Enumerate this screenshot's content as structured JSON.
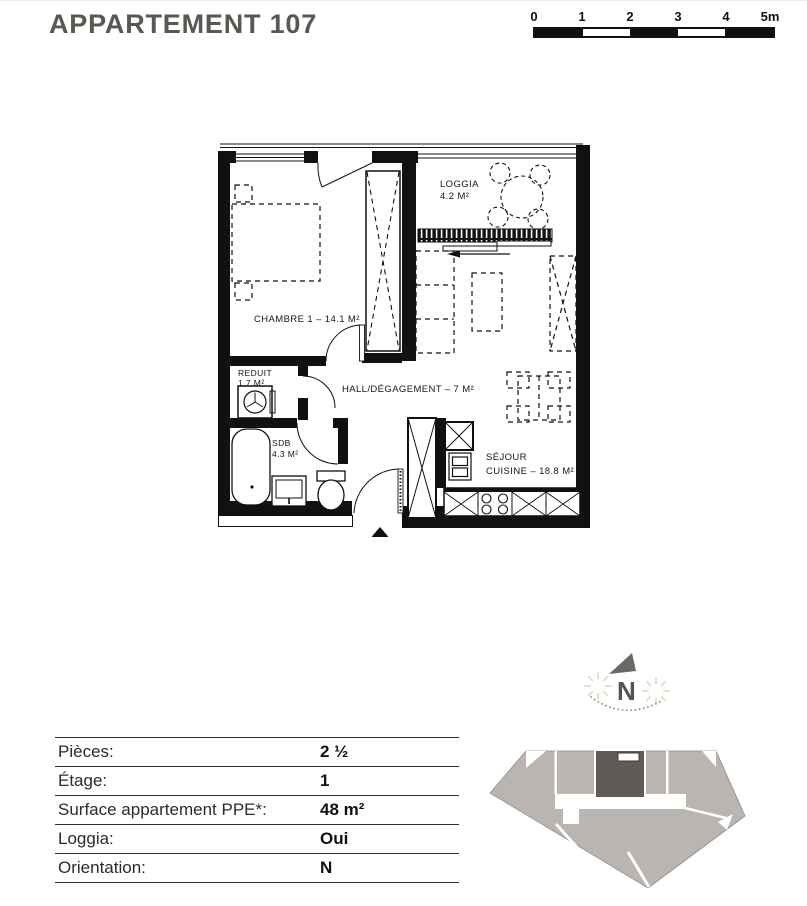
{
  "header": {
    "title": "APPARTEMENT 107"
  },
  "scale_bar": {
    "ticks": [
      "0",
      "1",
      "2",
      "3",
      "4",
      "5m"
    ]
  },
  "floor_plan": {
    "rooms": {
      "loggia": {
        "name": "LOGGIA",
        "area": "4.2 M²"
      },
      "chambre": {
        "label": "CHAMBRE 1 – 14.1 M²"
      },
      "reduit": {
        "name": "REDUIT",
        "area": "1.7 M²"
      },
      "hall": {
        "label": "HALL/DÉGAGEMENT – 7 M²"
      },
      "sdb": {
        "name": "SDB",
        "area": "4.3 M²"
      },
      "sejour_cuisine": {
        "line1": "SÉJOUR",
        "line2": "CUISINE – 18.8 M²"
      }
    }
  },
  "compass": {
    "north_label": "N"
  },
  "info_table": {
    "rows": [
      {
        "label": "Pièces:",
        "value": "2 ½"
      },
      {
        "label": "Étage:",
        "value": "1"
      },
      {
        "label": "Surface appartement PPE*:",
        "value": "48 m²"
      },
      {
        "label": "Loggia:",
        "value": "Oui"
      },
      {
        "label": "Orientation:",
        "value": "N"
      }
    ]
  },
  "colors": {
    "wall_black": "#111111",
    "title_gray": "#5b5752",
    "building_gray": "#bab5b1",
    "unit_dark": "#5f5a55",
    "sun_beige": "#e8dfc9"
  }
}
